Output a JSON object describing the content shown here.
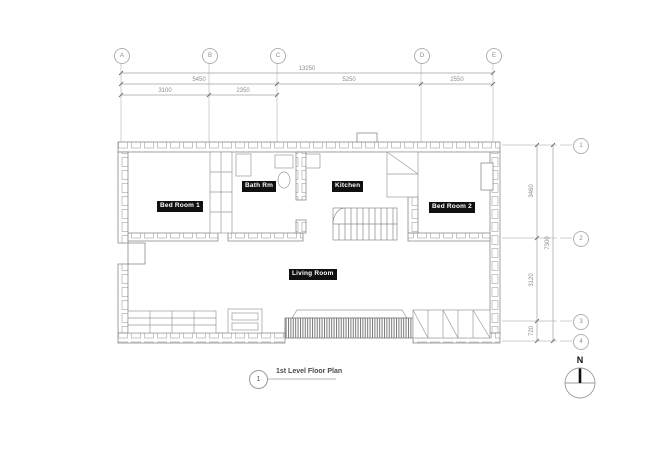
{
  "drawing": {
    "title_number": "1",
    "title": "1st Level Floor Plan",
    "north_label": "N"
  },
  "column_grid": {
    "markers": [
      {
        "label": "A"
      },
      {
        "label": "B"
      },
      {
        "label": "C"
      },
      {
        "label": "D"
      },
      {
        "label": "E"
      }
    ],
    "dims_row1": [
      {
        "value": "13250"
      }
    ],
    "dims_row2": [
      {
        "value": "5450"
      },
      {
        "value": "5250"
      },
      {
        "value": "2550"
      }
    ],
    "dims_row3": [
      {
        "value": "3100"
      },
      {
        "value": "2350"
      }
    ]
  },
  "row_grid": {
    "markers": [
      {
        "label": "1"
      },
      {
        "label": "2"
      },
      {
        "label": "3"
      },
      {
        "label": "4"
      }
    ],
    "segment_dims": [
      {
        "value": "3460"
      },
      {
        "value": "3120"
      },
      {
        "value": "720"
      }
    ],
    "total_dim": "7300"
  },
  "rooms": [
    {
      "name": "Bed Room 1"
    },
    {
      "name": "Bath Rm"
    },
    {
      "name": "Kitchen"
    },
    {
      "name": "Bed Room 2"
    },
    {
      "name": "Living Room"
    }
  ],
  "colors": {
    "background": "#ffffff",
    "drawing_line": "#909090",
    "dimension_line": "#9c9c9c",
    "dimension_text": "#8d8d8d",
    "room_tag_bg": "#101010",
    "room_tag_text": "#ffffff",
    "north_needle": "#111111"
  }
}
